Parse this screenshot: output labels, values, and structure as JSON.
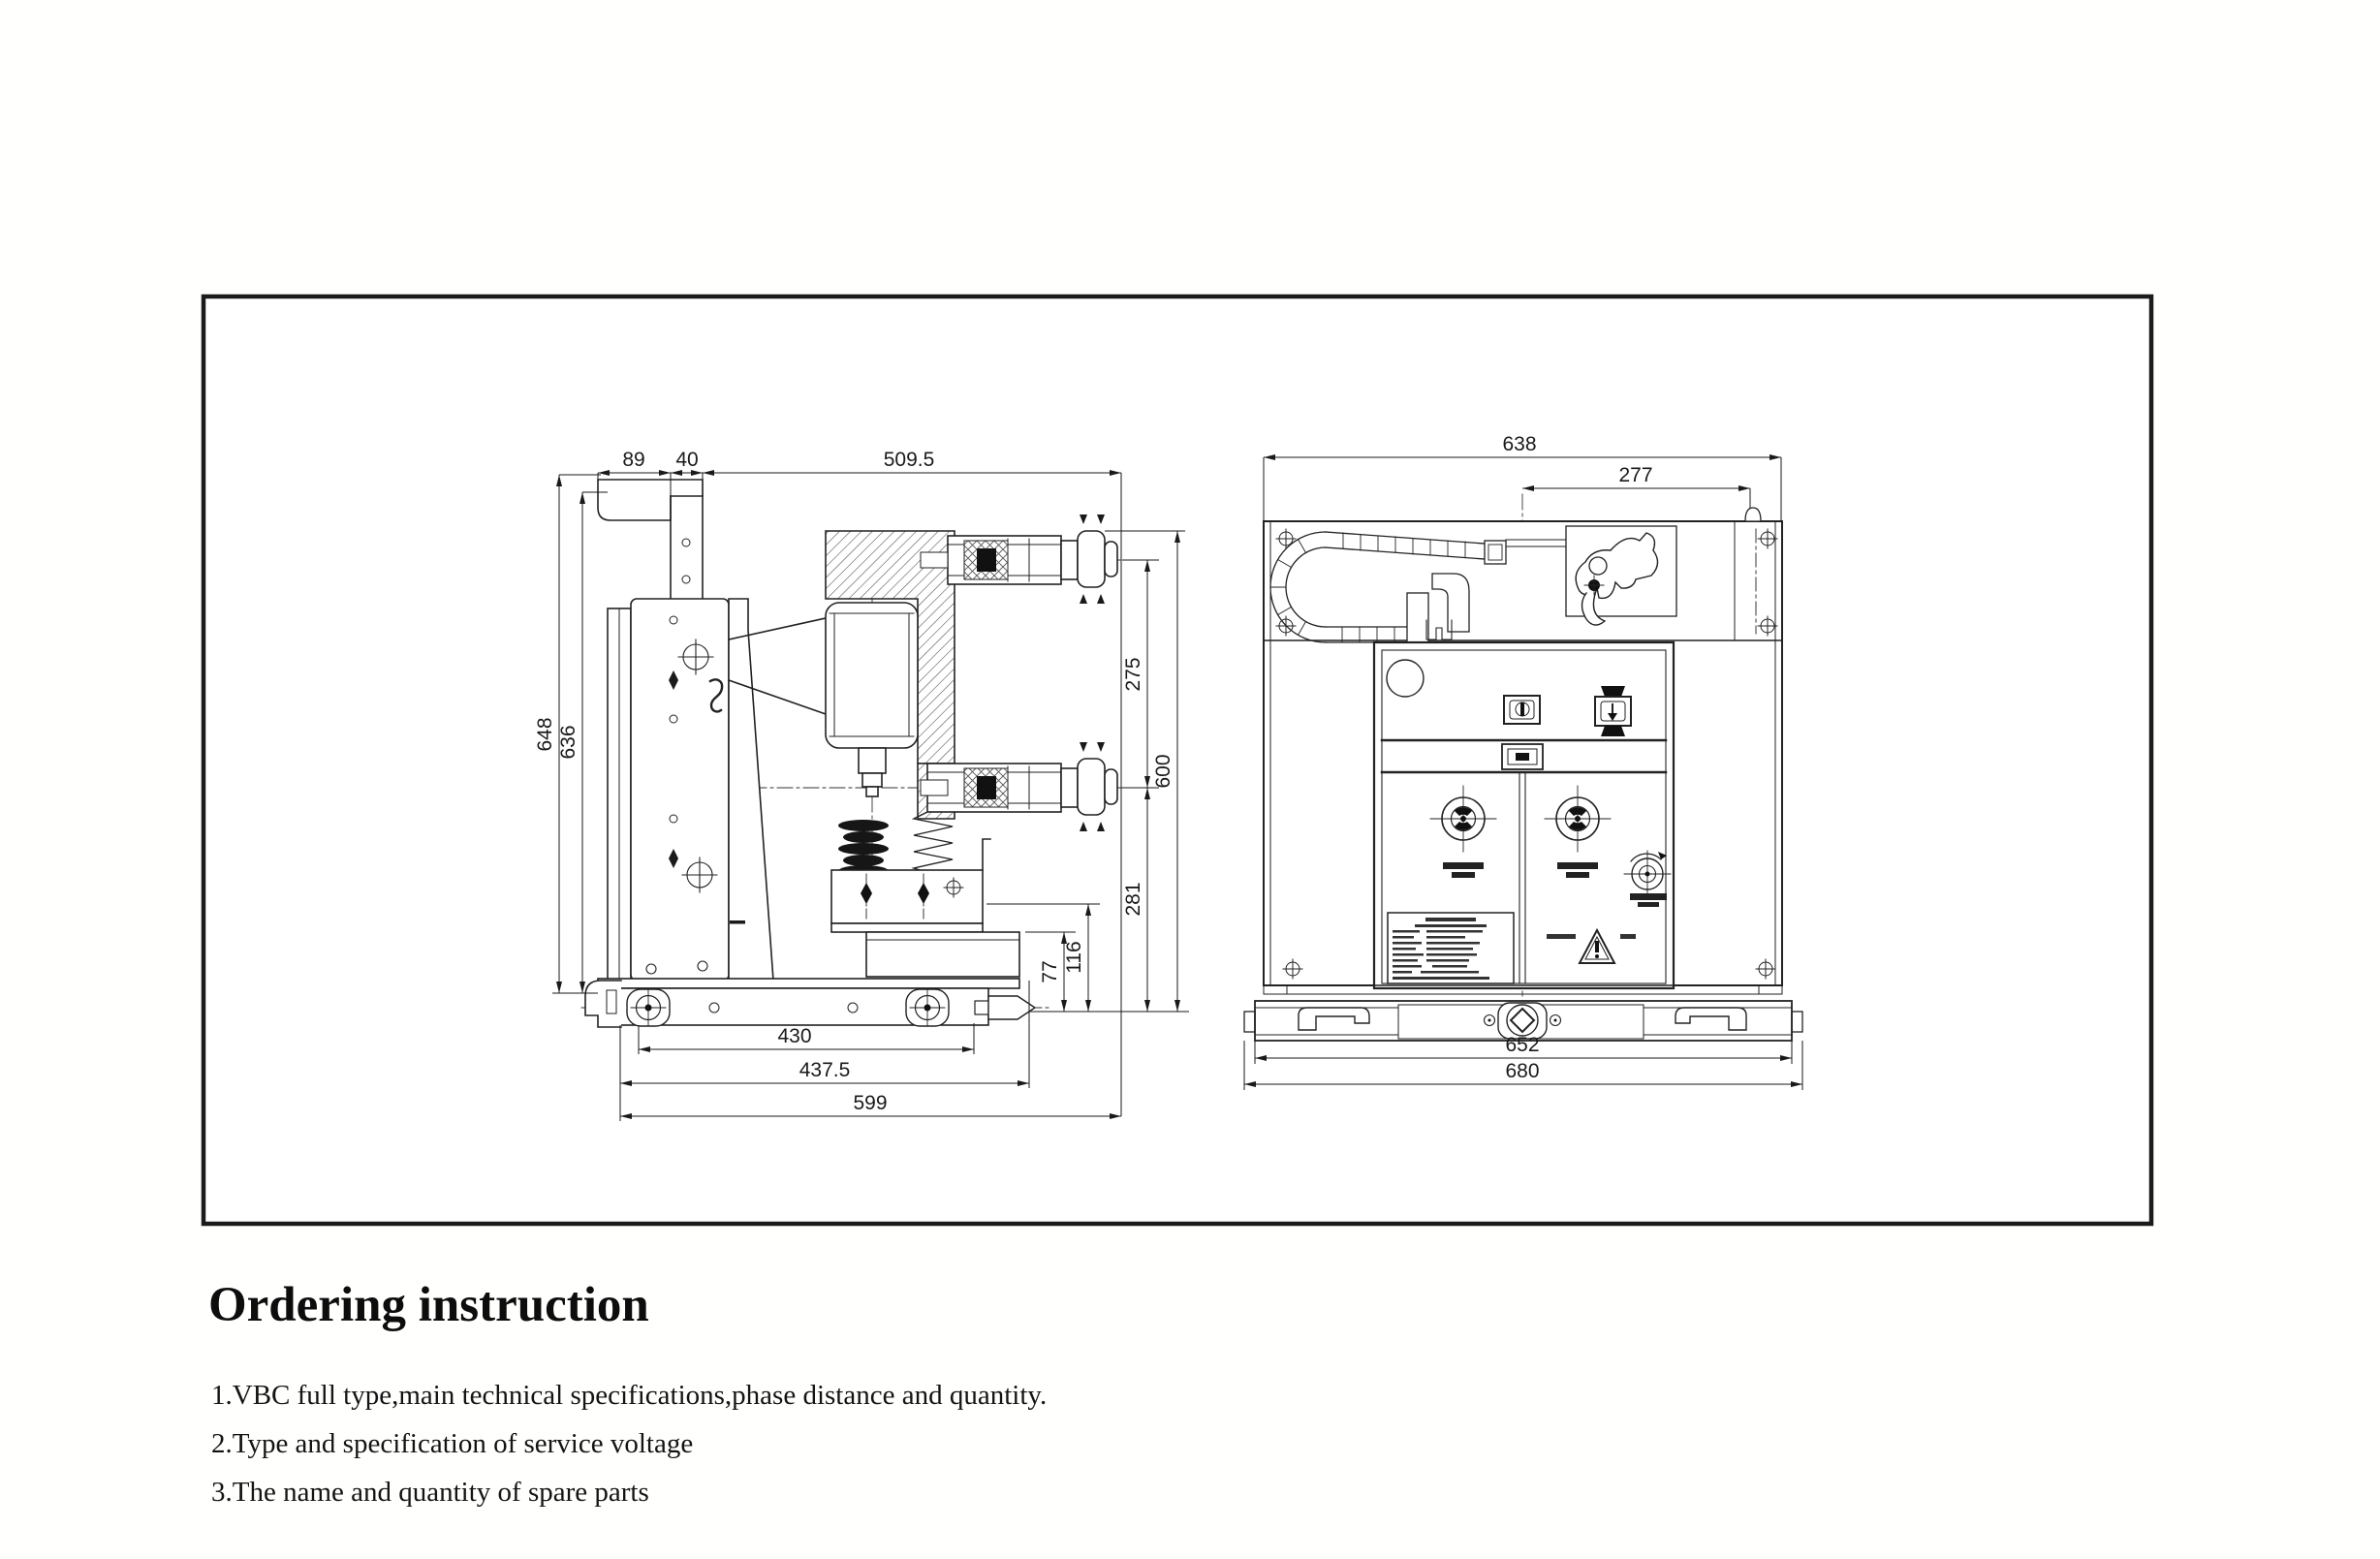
{
  "colors": {
    "ink": "#1a1a1a",
    "paper": "#ffffff",
    "border": "#1b1b1b"
  },
  "drawing": {
    "side_view_dims": {
      "d89": "89",
      "d40": "40",
      "d509_5": "509.5",
      "d648": "648",
      "d636": "636",
      "d275": "275",
      "d600": "600",
      "d281": "281",
      "d116": "116",
      "d77": "77",
      "d430": "430",
      "d437_5": "437.5",
      "d599": "599"
    },
    "front_view_dims": {
      "d638": "638",
      "d277": "277",
      "d652": "652",
      "d680": "680"
    }
  },
  "ordering": {
    "heading": "Ordering instruction",
    "items": [
      {
        "text": "1.VBC full type,main technical specifications,phase distance and quantity."
      },
      {
        "text": "2.Type and specification of service voltage"
      },
      {
        "text": "3.The name and quantity of spare parts"
      }
    ]
  }
}
